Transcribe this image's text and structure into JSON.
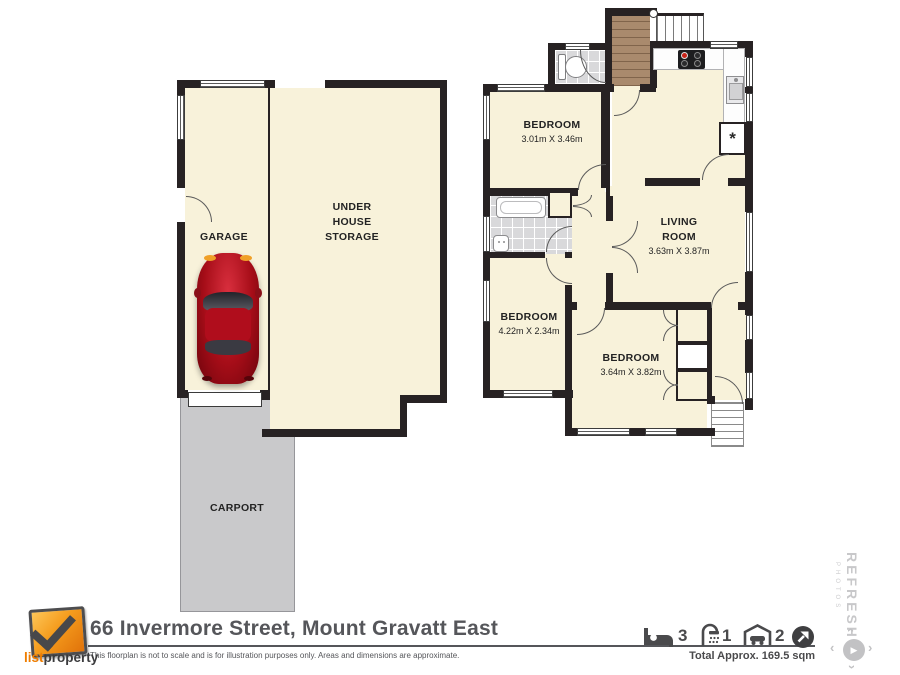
{
  "plan": {
    "rooms": {
      "garage": {
        "name": "GARAGE"
      },
      "storage": {
        "l1": "UNDER",
        "l2": "HOUSE",
        "l3": "STORAGE"
      },
      "carport": {
        "name": "CARPORT"
      },
      "bedroom1": {
        "name": "BEDROOM",
        "dims": "3.01m X 3.46m"
      },
      "bedroom2": {
        "name": "BEDROOM",
        "dims": "4.22m X 2.34m"
      },
      "bedroom3": {
        "name": "BEDROOM",
        "dims": "3.64m X 3.82m"
      },
      "living": {
        "l1": "LIVING",
        "l2": "ROOM",
        "dims": "3.63m X 3.87m"
      }
    },
    "symbols": {
      "hot_water": "*"
    }
  },
  "footer": {
    "brand": {
      "part1": "list",
      "part2": "property"
    },
    "address": "66 Invermore Street, Mount Gravatt East",
    "disclaimer": "This floorplan is not to scale and is for illustration purposes only. Areas and dimensions are approximate.",
    "stats": {
      "beds": "3",
      "bathrooms": "1",
      "cars": "2"
    },
    "total": "Total Approx. 169.5 sqm"
  },
  "watermark": {
    "brand": "REFRESH",
    "sub": "PHOTOS"
  },
  "colors": {
    "floor": "#f8f2da",
    "wall": "#272223",
    "carport": "#c9c9cb",
    "deck": "#a98a6d",
    "tile": "#d9d9db",
    "brand_orange": "#ef7d00",
    "text_gray": "#55565a",
    "car_red": "#a60d18"
  }
}
